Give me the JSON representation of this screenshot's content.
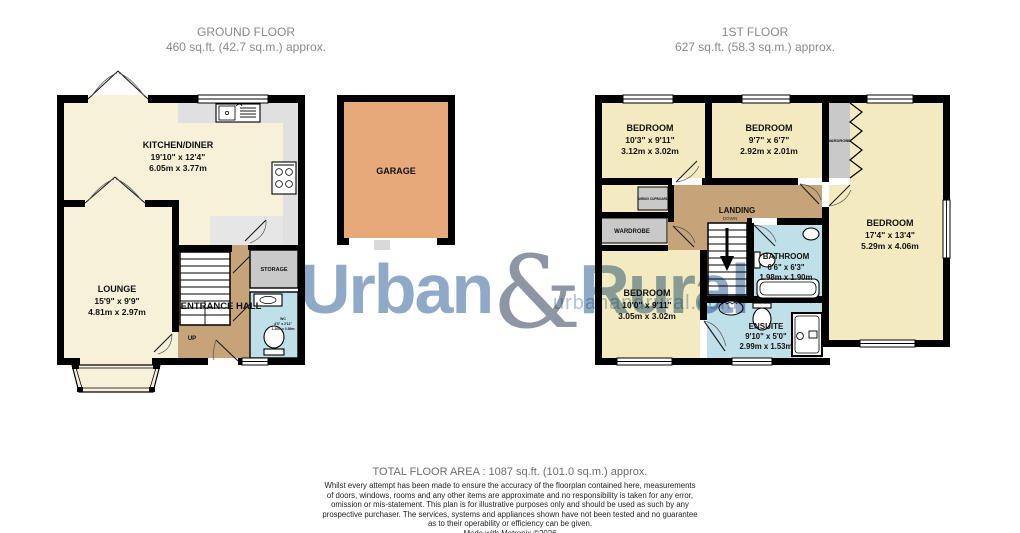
{
  "ground_floor": {
    "title": "GROUND FLOOR",
    "area": "460 sq.ft. (42.7 sq.m.) approx.",
    "rooms": {
      "kitchen": {
        "name": "KITCHEN/DINER",
        "imperial": "19'10\" x 12'4\"",
        "metric": "6.05m x 3.77m"
      },
      "lounge": {
        "name": "LOUNGE",
        "imperial": "15'9\" x 9'9\"",
        "metric": "4.81m x 2.97m"
      },
      "hall": {
        "name": "ENTRANCE HALL",
        "up": "UP"
      },
      "storage": {
        "name": "STORAGE"
      },
      "wc": {
        "name": "WC",
        "imperial": "4'3\" x 2'11\"",
        "metric": "1.30m x 0.89m"
      }
    }
  },
  "garage": {
    "name": "GARAGE"
  },
  "first_floor": {
    "title": "1ST FLOOR",
    "area": "627 sq.ft. (58.3 sq.m.) approx.",
    "rooms": {
      "bedroom1": {
        "name": "BEDROOM",
        "imperial": "10'3\" x 9'11\"",
        "metric": "3.12m x 3.02m"
      },
      "bedroom2": {
        "name": "BEDROOM",
        "imperial": "9'7\" x 6'7\"",
        "metric": "2.92m x 2.01m"
      },
      "bedroom3": {
        "name": "BEDROOM",
        "imperial": "17'4\" x 13'4\"",
        "metric": "5.29m x 4.06m"
      },
      "bedroom4": {
        "name": "BEDROOM",
        "imperial": "10'0\" x 9'11\"",
        "metric": "3.05m x 3.02m"
      },
      "landing": {
        "name": "LANDING",
        "down": "DOWN"
      },
      "bathroom": {
        "name": "BATHROOM",
        "imperial": "6'6\" x 6'3\"",
        "metric": "1.98m x 1.90m"
      },
      "ensuite": {
        "name": "ENSUITE",
        "imperial": "9'10\" x 5'0\"",
        "metric": "2.99m x 1.53m"
      },
      "wardrobe_left": {
        "name": "WARDROBE"
      },
      "wardrobe_strip": {
        "name": "WARDROBE"
      },
      "airing": {
        "name": "AIRING CUPBOARD"
      }
    }
  },
  "watermark": {
    "brand_first": "Urban",
    "brand_amp": "&",
    "brand_second": "Rural",
    "url": "urbanandrural.com"
  },
  "footer": {
    "total": "TOTAL FLOOR AREA : 1087 sq.ft. (101.0 sq.m.) approx.",
    "disclaimer_lines": [
      "Whilst every attempt has been made to ensure the accuracy of the floorplan contained here, measurements",
      "of doors, windows, rooms and any other items are approximate and no responsibility is taken for any error,",
      "omission or mis-statement. This plan is for illustrative purposes only and should be used as such by any",
      "prospective purchaser. The services, systems and appliances shown have not been tested and no guarantee",
      "as to their operability or efficiency can be given.",
      "Made with Metropix ©2026"
    ]
  },
  "colors": {
    "wall": "#000000",
    "cream_ground": "#F7F1DA",
    "cream_first": "#F3EABF",
    "tan": "#C6A379",
    "blue": "#BFE0E9",
    "gray_unit": "#C9C9C9",
    "counter": "#E0E0E0",
    "floor_gray": "#E6E6E6",
    "garage": "#E7A97A",
    "title_text": "#8A8A8A",
    "watermark_blue": "#8FA9C7",
    "watermark_amp": "#8F96A3",
    "watermark_url": "#AFC5D6"
  }
}
